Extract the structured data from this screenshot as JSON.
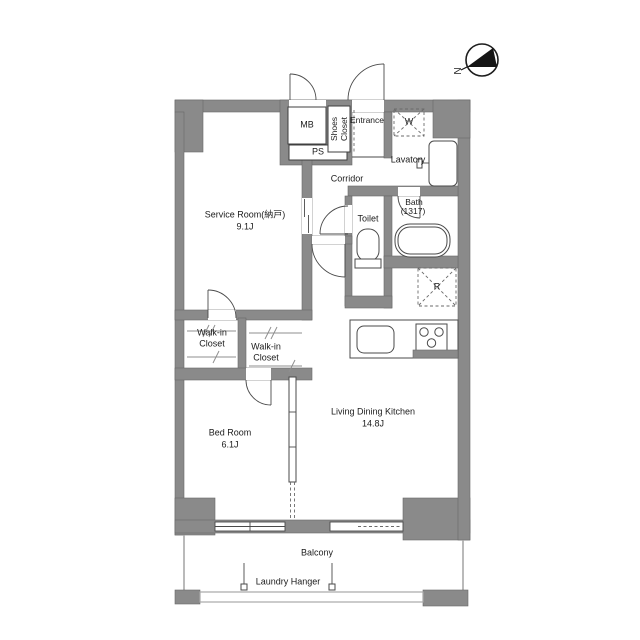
{
  "compass": {
    "label": "N"
  },
  "colors": {
    "wall": "#8a8a8a",
    "wall_edge": "#686868",
    "text": "#1c1c1c"
  },
  "rooms": {
    "mb": {
      "label": "MB"
    },
    "ps": {
      "label": "PS"
    },
    "shoes_closet": {
      "label": "Shoes\nCloset"
    },
    "entrance": {
      "label": "Entrance"
    },
    "washing_machine": {
      "label": "W"
    },
    "lavatory": {
      "label": "Lavatory"
    },
    "corridor": {
      "label": "Corridor"
    },
    "bath": {
      "label": "Bath",
      "size": "(1317)"
    },
    "toilet": {
      "label": "Toilet"
    },
    "refrigerator": {
      "label": "R"
    },
    "service_room": {
      "label": "Service Room(納戸)",
      "size": "9.1J"
    },
    "walk_in_closet_left": {
      "label": "Walk-in\nCloset"
    },
    "walk_in_closet_right": {
      "label": "Walk-in\nCloset"
    },
    "bed_room": {
      "label": "Bed Room",
      "size": "6.1J"
    },
    "ldk": {
      "label": "Living Dining Kitchen",
      "size": "14.8J"
    },
    "balcony": {
      "label": "Balcony"
    },
    "laundry_hanger": {
      "label": "Laundry Hanger"
    }
  }
}
